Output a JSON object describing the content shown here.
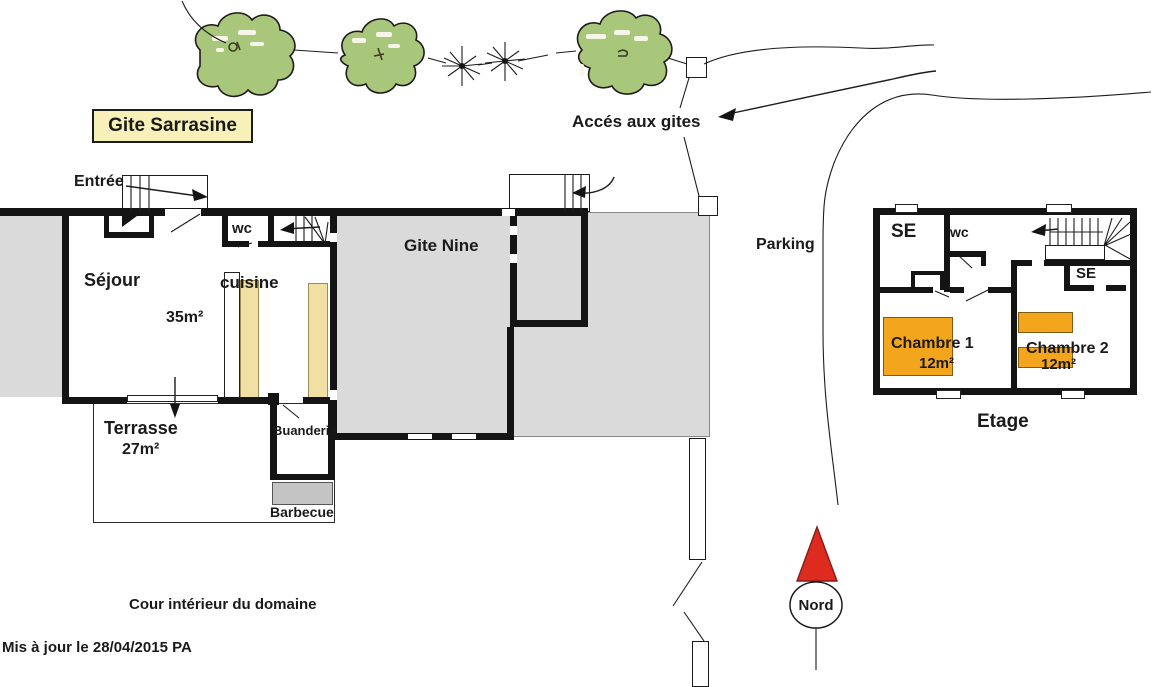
{
  "title_box": {
    "label": "Gite Sarrasine"
  },
  "site": {
    "acces": "Accés aux gites",
    "parking": "Parking",
    "cour": "Cour intérieur du domaine",
    "updated": "Mis à jour le 28/04/2015  PA",
    "nord": "Nord"
  },
  "gite_sarrasine": {
    "entree": "Entrée",
    "sejour": "Séjour",
    "sejour_area": "35m²",
    "cuisine": "cuisine",
    "wc": "wc",
    "terrasse": "Terrasse",
    "terrasse_area": "27m²",
    "buanderie": "Buanderie",
    "barbecue": "Barbecue"
  },
  "gite_nine": {
    "label": "Gite Nine"
  },
  "etage": {
    "se1": "SE",
    "wc": "wc",
    "se2": "SE",
    "chambre1": "Chambre 1",
    "chambre1_area": "12m²",
    "chambre2": "Chambre 2",
    "chambre2_area": "12m²",
    "label": "Etage"
  },
  "colors": {
    "tree_green": "#A9C77B",
    "room_gray": "#DADADA",
    "barbecue_gray": "#C4C4C4",
    "counter_yellow": "#F0E0A3",
    "bed_orange": "#F3A61D",
    "north_red": "#DD2B20",
    "title_box_yellow": "#F7F0B9",
    "wall_black": "#141414",
    "text_ink": "#1a1a1a"
  }
}
